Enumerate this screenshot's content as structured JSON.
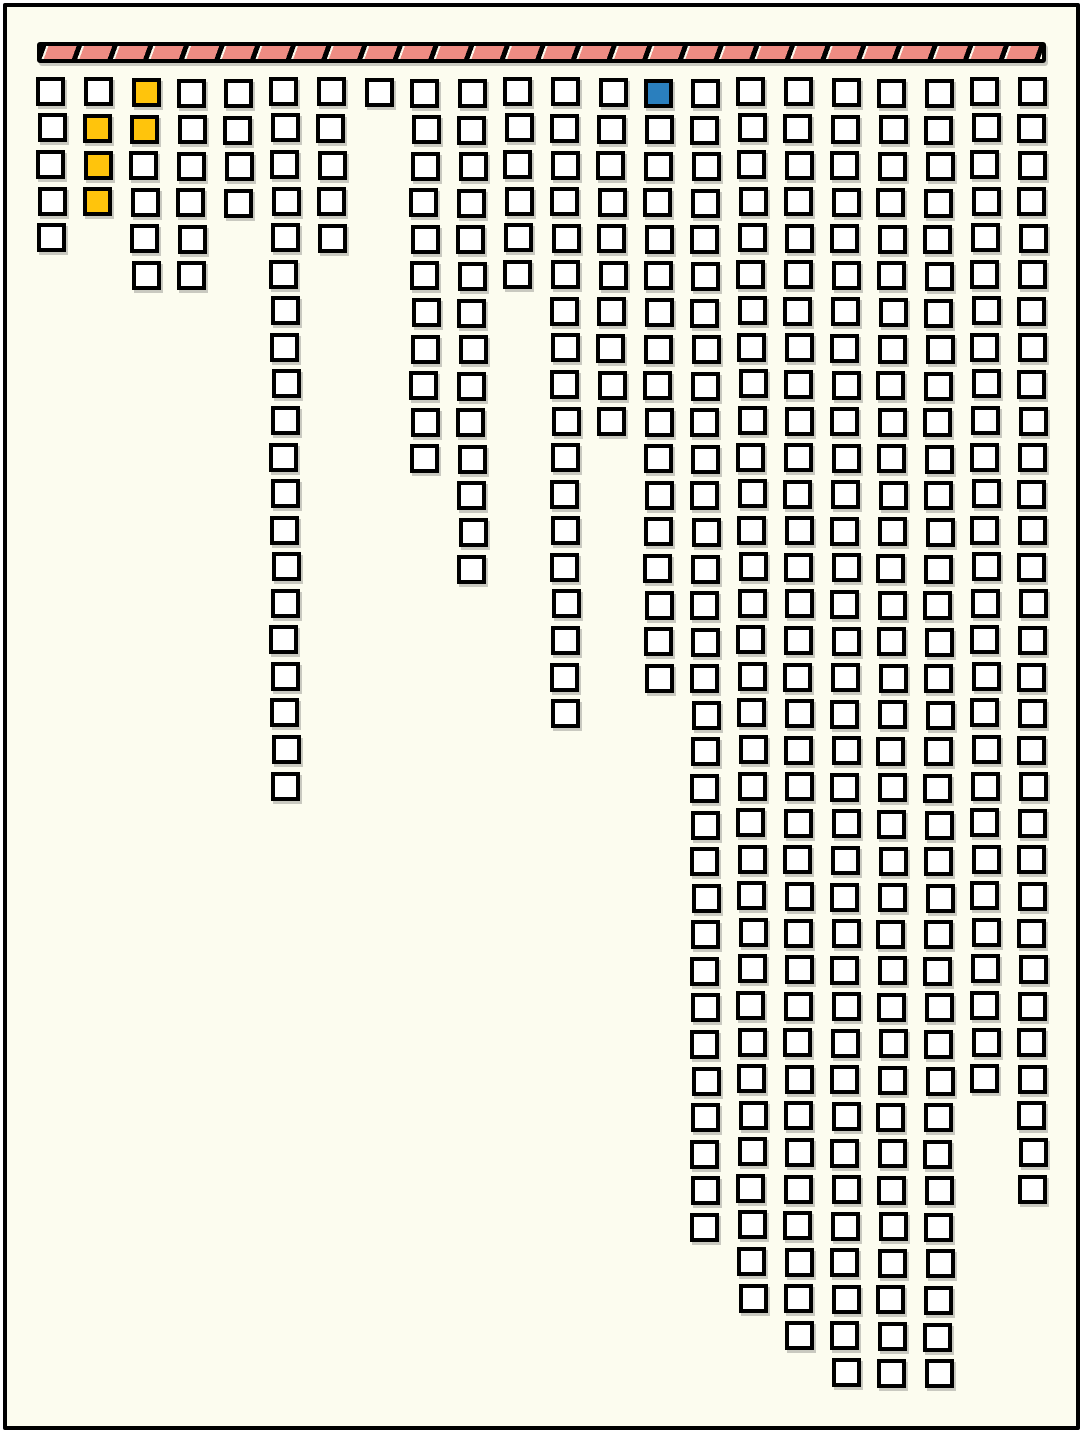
{
  "chart_data": {
    "type": "bar",
    "title": "",
    "subtitle": "",
    "xlabel": "",
    "ylabel": "",
    "orientation": "columns of outlined square cells hang downward from a hatched ceiling bar",
    "legend": [],
    "categories": [
      1,
      2,
      3,
      4,
      5,
      6,
      7,
      8,
      9,
      10,
      11,
      12,
      13,
      14,
      15,
      16,
      17,
      18,
      19,
      20,
      21,
      22
    ],
    "values": [
      5,
      4,
      6,
      6,
      4,
      20,
      5,
      1,
      11,
      14,
      6,
      18,
      10,
      17,
      32,
      34,
      35,
      36,
      36,
      36,
      28,
      31
    ],
    "max_rows": 36,
    "total_cells": 395,
    "highlighted_cells": [
      {
        "column": 2,
        "row": 2,
        "color": "yellow"
      },
      {
        "column": 2,
        "row": 3,
        "color": "yellow"
      },
      {
        "column": 2,
        "row": 4,
        "color": "yellow"
      },
      {
        "column": 3,
        "row": 1,
        "color": "yellow"
      },
      {
        "column": 3,
        "row": 2,
        "color": "yellow"
      },
      {
        "column": 14,
        "row": 1,
        "color": "blue"
      }
    ],
    "ceiling_bar": {
      "style": "pink bar with black border and black diagonal slash dividers",
      "stripe_direction": "/"
    }
  },
  "colors": {
    "background": "#FCFCEF",
    "frame_border": "#000000",
    "cell_fill": "#FFFFFF",
    "cell_outline": "#000000",
    "cell_shadow": "#C9C9C0",
    "yellow": "#FFC40C",
    "blue": "#2A7FBE",
    "bar_pink": "#EE8C83",
    "bar_highlight": "#FBF8EC"
  }
}
